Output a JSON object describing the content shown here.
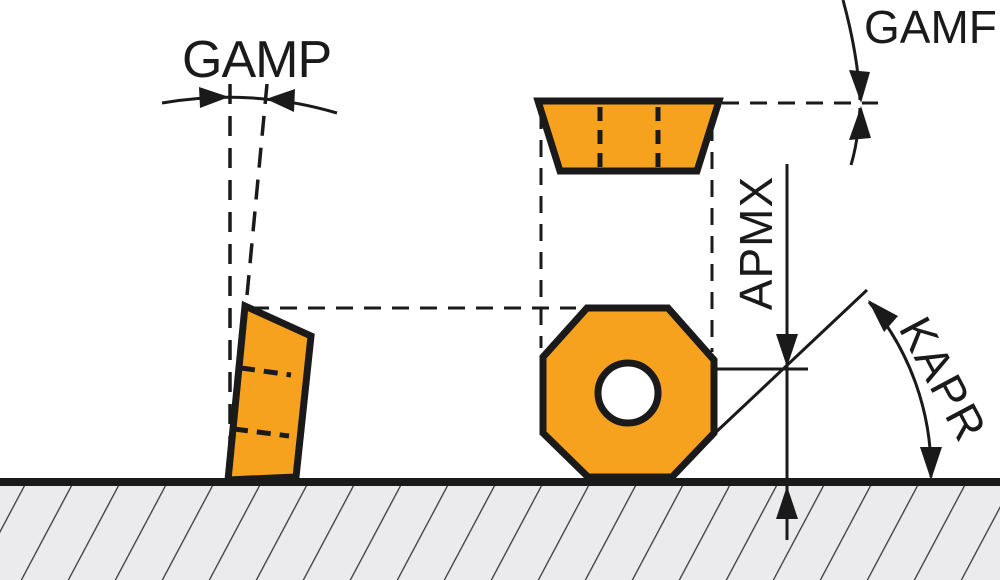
{
  "diagram": {
    "kind": "milling-insert-geometry-diagram",
    "labels": {
      "gamp": "GAMP",
      "gamf": "GAMF",
      "apmx": "APMX",
      "kapr": "KAPR"
    },
    "colors": {
      "insert_fill": "#F6A21E",
      "outline": "#1A1A1A",
      "ground_fill": "#EBEBED",
      "hatch_line": "#3A3A3A",
      "hole_fill": "#FFFFFF",
      "background": "#FFFFFF"
    }
  }
}
